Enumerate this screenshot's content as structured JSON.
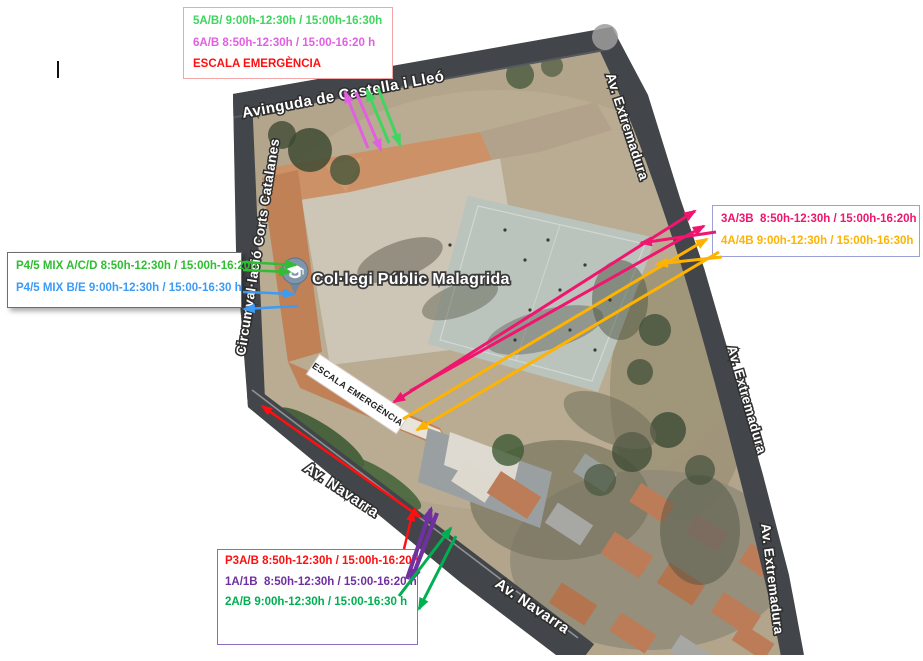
{
  "colors": {
    "green_top": "#3fd55e",
    "magenta": "#e25fe2",
    "red": "#ff0f0f",
    "green_left": "#2fbe31",
    "blue": "#3b9bf5",
    "pink": "#f0156e",
    "orange": "#ffb300",
    "purple": "#7030a0",
    "green_dark": "#00b050"
  },
  "map_palette": {
    "terrain": "#b3a58c",
    "road": "#42464a",
    "roof": "#cc9166",
    "roof_gray": "#b2a28b",
    "yard": "#cdc5b5",
    "court": "#bac3bc",
    "house": "#bd7c58"
  },
  "legend_top": {
    "line1": "5A/B/ 9:00h-12:30h / 15:00h-16:30h",
    "line2": "6A/B 8:50h-12:30h / 15:00-16:20 h",
    "line3": "ESCALA EMERGÈNCIA"
  },
  "legend_left": {
    "line1": "P4/5 MIX A/C/D 8:50h-12:30h / 15:00h-16:20h",
    "line2": "P4/5 MIX B/E 9:00h-12:30h / 15:00-16:30 h"
  },
  "legend_right": {
    "line1": "3A/3B  8:50h-12:30h / 15:00h-16:20h",
    "line2": "4A/4B 9:00h-12:30h / 15:00h-16:30h"
  },
  "legend_bottom": {
    "line1": "P3A/B 8:50h-12:30h / 15:00h-16:20h",
    "line2": "1A/1B  8:50h-12:30h / 15:00-16:20 h",
    "line3": "2A/B 9:00h-12:30h / 15:00-16:30 h"
  },
  "map": {
    "place_label": "Col·legi Públic Malagrida",
    "emergency_sign": "ESCALA EMERGÈNCIA",
    "street_top": "Avinguda de Castella i Lleó",
    "street_left": "Circumval·lació Corts Catalanes",
    "street_right": "Av. Extremadura",
    "street_bottom": "Av. Navarra",
    "pin_icon": "graduation-cap-pin"
  }
}
